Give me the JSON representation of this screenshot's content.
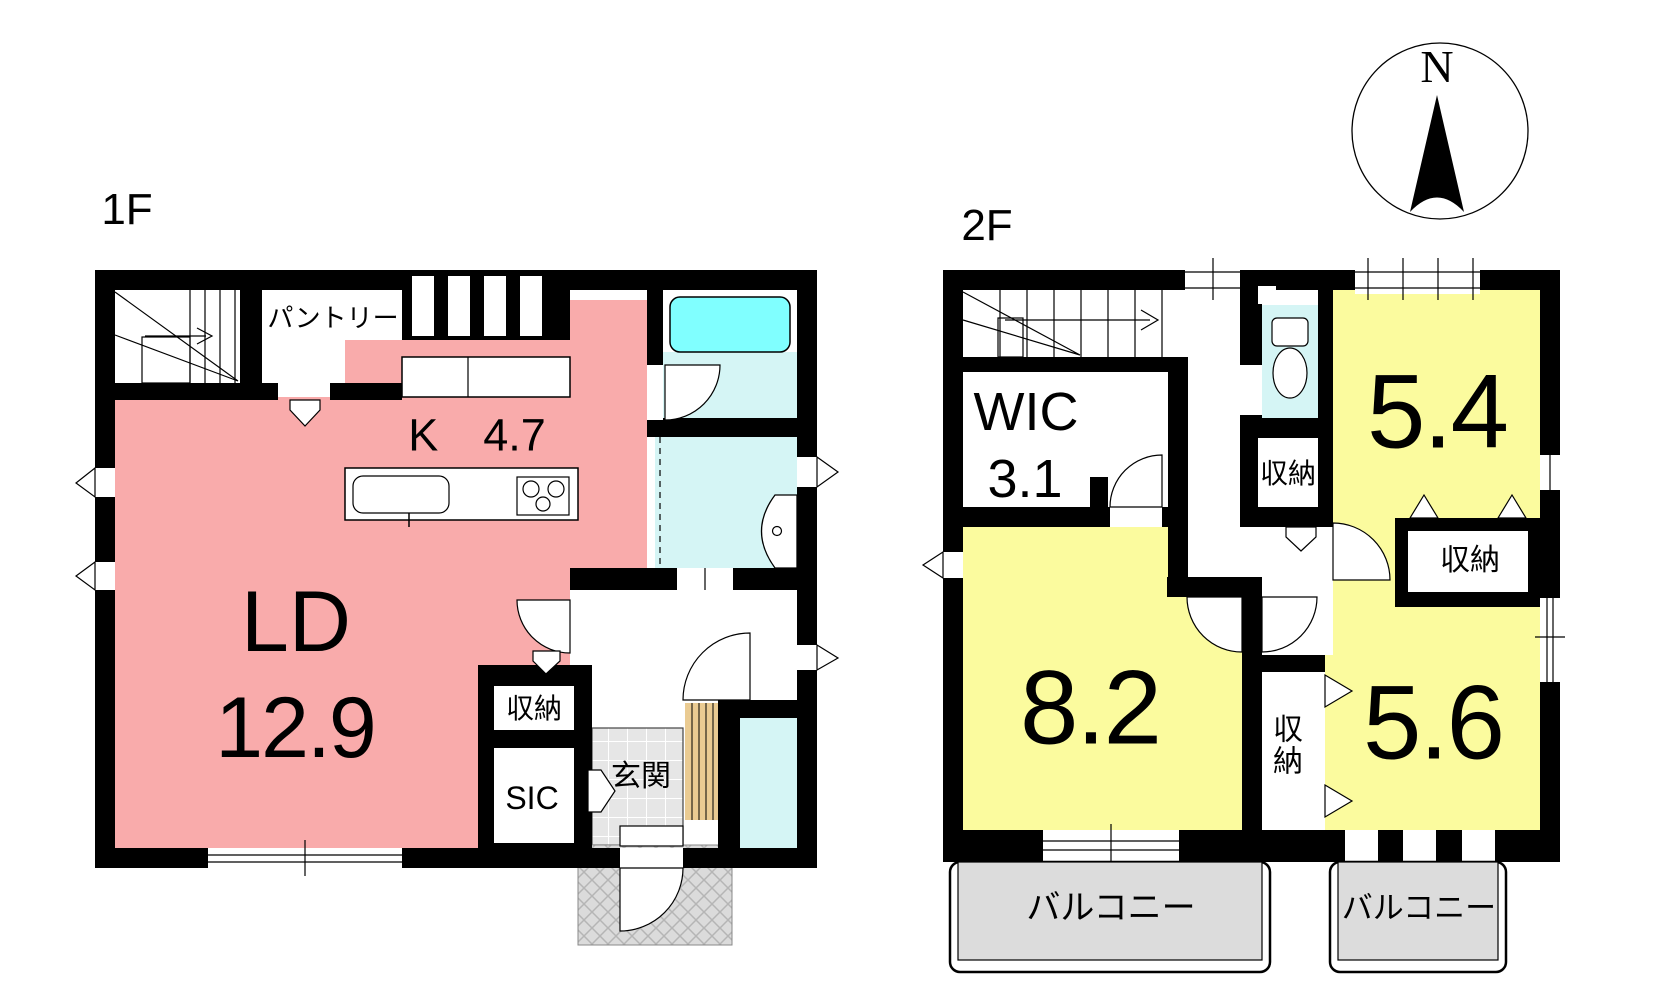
{
  "compass": {
    "north": "N"
  },
  "floor1": {
    "title": "1F",
    "pantry": "パントリー",
    "kitchen": "K　4.7",
    "living_dining": "LD",
    "living_dining_size": "12.9",
    "storage": "収納",
    "shoe_closet": "SIC",
    "entrance": "玄関"
  },
  "floor2": {
    "title": "2F",
    "wic": "WIC",
    "wic_size": "3.1",
    "room_5_4": "5.4",
    "room_8_2": "8.2",
    "room_5_6": "5.6",
    "storage_hall": "収納",
    "storage_between_rooms": "収納",
    "storage_side": "収納",
    "balcony_left": "バルコニー",
    "balcony_right": "バルコニー"
  },
  "colors": {
    "room_pink": "#F9ABAB",
    "room_yellow": "#FBFB9E",
    "fixture_cyan": "#80FFFF",
    "wet_area_cyan": "#D5F5F5",
    "balcony_gray": "#DCDCDC",
    "entrance_tile_gray": "#E6E6E6",
    "porch_gray": "#DBDBDB",
    "wood_step_tan": "#EACB92",
    "wall_black": "#000000"
  }
}
